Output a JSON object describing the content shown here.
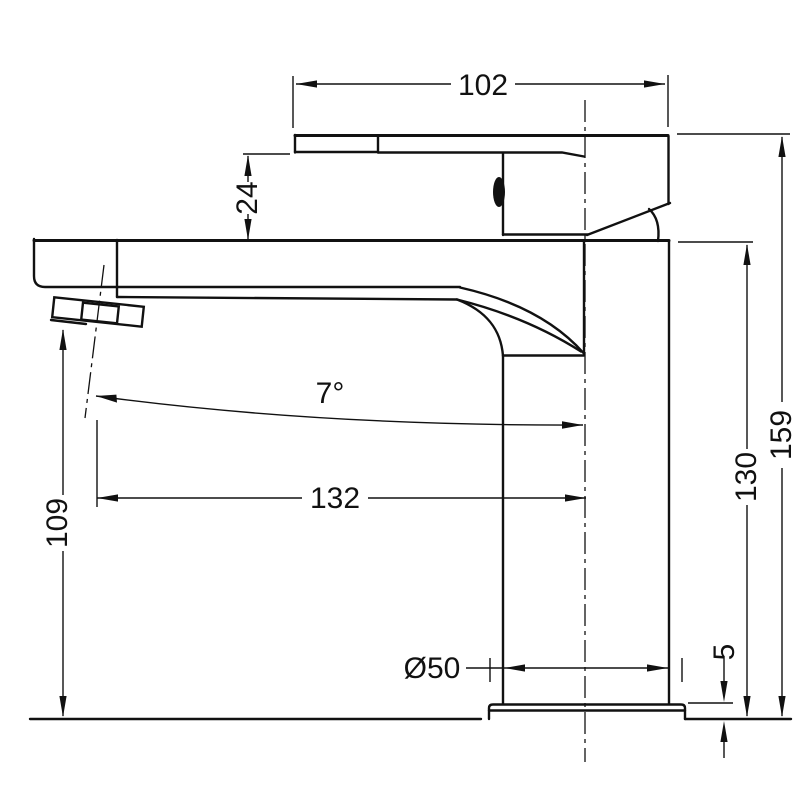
{
  "drawing": {
    "type": "technical-dimension-drawing",
    "subject": "single-lever basin mixer tap - side elevation",
    "background": "#ffffff",
    "line_color": "#111111",
    "dimensions": {
      "handle_width": "102",
      "lever_drop": "24",
      "spout_angle": "7°",
      "spout_reach": "132",
      "spout_outlet_height": "109",
      "body_height": "130",
      "overall_height": "159",
      "base_thickness": "5",
      "base_diameter": "Ø50"
    }
  }
}
